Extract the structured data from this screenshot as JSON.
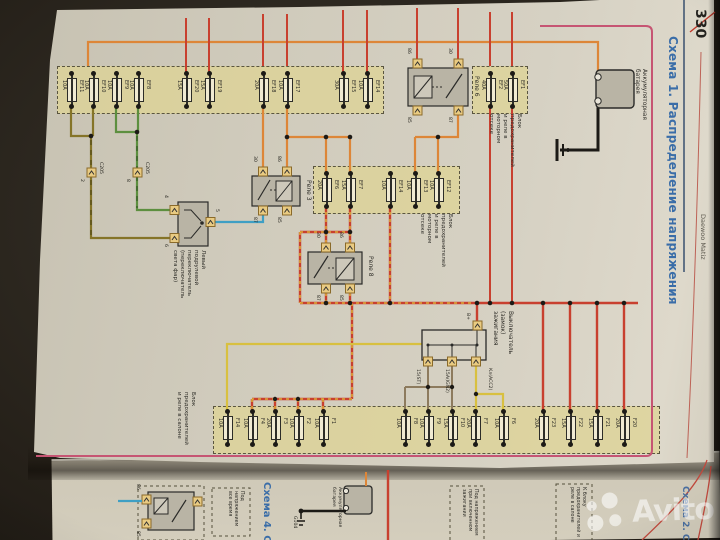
{
  "page": {
    "number": "330",
    "brand": "Daewoo Matiz",
    "title": "Схема 1. Распределение напряжения"
  },
  "watermark": {
    "label": "Avito"
  },
  "diagram": {
    "battery_label": "Аккумуляторная батарея",
    "engine_box_label": "Блок предохранителей и реле в моторном отсеке",
    "cabin_box_label": "Блок предохранителей и реле в салоне",
    "ignition_label": "Выключатель (замок) зажигания",
    "ignition_pins": [
      "B+",
      "15(ST)",
      "15A(IGN2)",
      "Кл(АСС2)"
    ],
    "switch_label": "Левый подрулевой переключатель (переключатель света фар)",
    "switch_pins": [
      "4",
      "6",
      "5"
    ],
    "connector_id": "C205",
    "connector_pins": [
      "2",
      "8"
    ],
    "relays": [
      {
        "name": "Реле 6",
        "pins": [
          "86",
          "30",
          "85",
          "87"
        ]
      },
      {
        "name": "Реле 3",
        "pins": [
          "30",
          "86",
          "87",
          "85"
        ]
      },
      {
        "name": "Реле 8",
        "pins": [
          "30",
          "86",
          "87",
          "85"
        ]
      }
    ],
    "fuses_top": [
      {
        "name": "EF11",
        "amps": "10A"
      },
      {
        "name": "EF10",
        "amps": "10A"
      },
      {
        "name": "EF9",
        "amps": "10A"
      },
      {
        "name": "EF8",
        "amps": "10A"
      },
      {
        "name": "EF20",
        "amps": "15A"
      },
      {
        "name": "EF19",
        "amps": "15A"
      },
      {
        "name": "EF18",
        "amps": "20A"
      },
      {
        "name": "EF17",
        "amps": "10A"
      },
      {
        "name": "EF15",
        "amps": "30A"
      },
      {
        "name": "EF14",
        "amps": "10A"
      }
    ],
    "fuses_battery": [
      {
        "name": "EF2",
        "amps": "40A"
      },
      {
        "name": "EF1",
        "amps": "50A"
      }
    ],
    "fuses_mid": [
      {
        "name": "EF6",
        "amps": "20A"
      },
      {
        "name": "EF7",
        "amps": "15A"
      },
      {
        "name": "EF14",
        "amps": "10A"
      },
      {
        "name": "EF13",
        "amps": "10A"
      },
      {
        "name": "EF12",
        "amps": "10A"
      }
    ],
    "fuses_cabin": [
      {
        "name": "F14",
        "amps": "10A"
      },
      {
        "name": "F4",
        "amps": "10A"
      },
      {
        "name": "F3",
        "amps": "20A"
      },
      {
        "name": "F2",
        "amps": "10A"
      },
      {
        "name": "F1",
        "amps": "10A"
      },
      {
        "name": "F8",
        "amps": "10A"
      },
      {
        "name": "F9",
        "amps": "10A"
      },
      {
        "name": "F10",
        "amps": "15A"
      },
      {
        "name": "F7",
        "amps": "20A"
      },
      {
        "name": "F6",
        "amps": "10A"
      },
      {
        "name": "F23",
        "amps": "20A"
      },
      {
        "name": "F22",
        "amps": "15A"
      },
      {
        "name": "F21",
        "amps": "15A"
      },
      {
        "name": "F20",
        "amps": "20A"
      }
    ]
  },
  "next_page": {
    "title": "Схема 4. С",
    "edge_title": "Схема 2. С",
    "battery_label": "Аккумуляторная батарея",
    "ground_label": "G104",
    "relay_pins": [
      "86",
      "85"
    ],
    "notes": [
      "Под напряжением все время",
      "Под напряжением при включенном зажигании",
      "К блоку предохранителей и реле в салоне"
    ]
  },
  "colors": {
    "paper": "#d5cfc0",
    "accent_pink": "#c65573",
    "title_blue": "#3a6da8",
    "fusebox_fill": "#ddd49e",
    "wire_orange": "#dd8638",
    "wire_red": "#c8402f",
    "wire_yellow": "#d8c040",
    "wire_green": "#5d8f3f",
    "wire_olive": "#857428",
    "wire_blue": "#3f9fc4",
    "wire_brown": "#8d7b5e"
  }
}
